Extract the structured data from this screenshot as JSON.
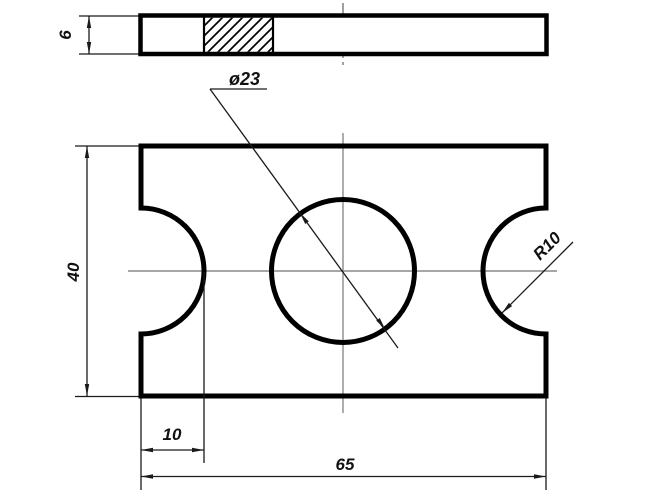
{
  "drawing": {
    "kind": "engineering-two-view-plate-drawing",
    "colors": {
      "outline": "#000000",
      "thin_line": "#1a1a1a",
      "centerline": "#8a8a8a",
      "background": "#ffffff"
    },
    "labels": {
      "thickness": "6",
      "hole_diameter": "ø23",
      "notch_radius": "R10",
      "height": "40",
      "notch_depth": "10",
      "width": "65"
    }
  }
}
